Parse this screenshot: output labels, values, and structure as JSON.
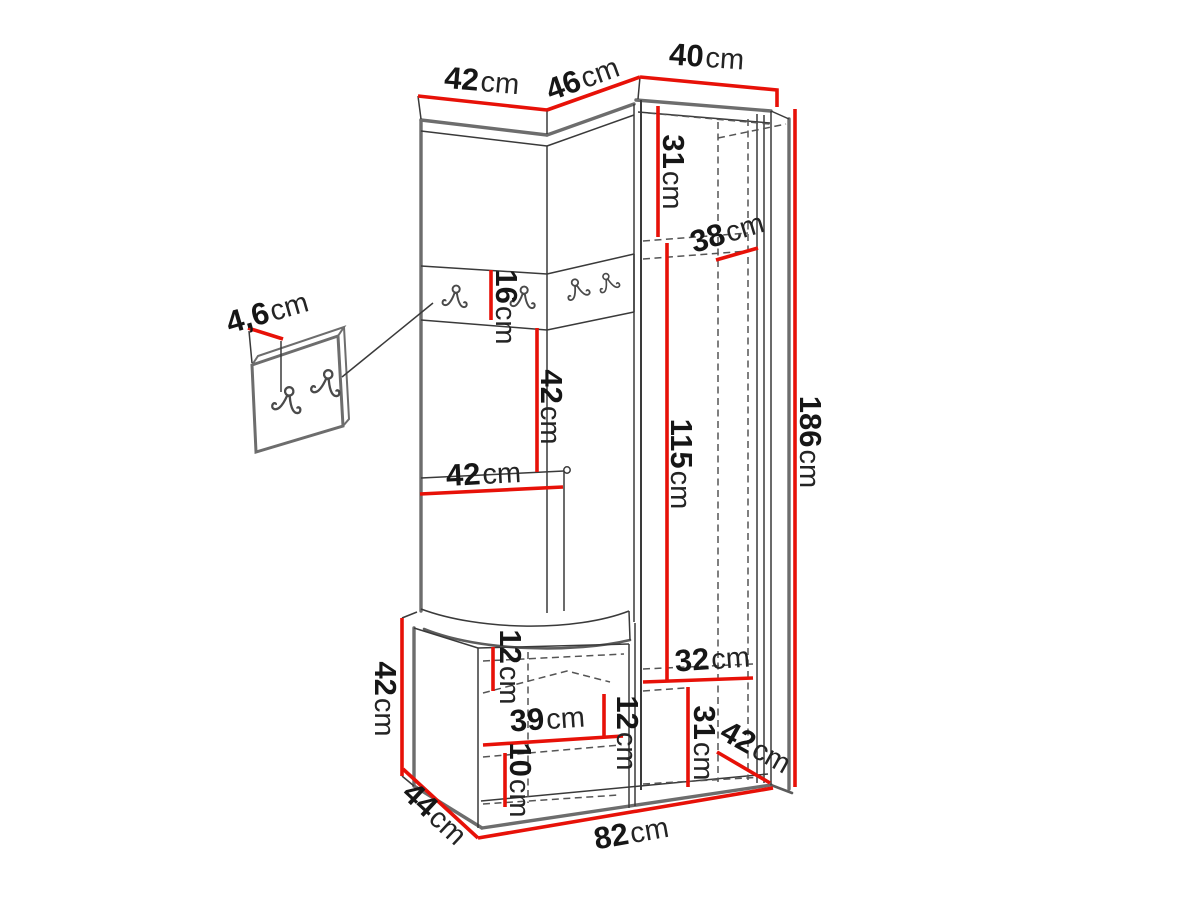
{
  "colors": {
    "dimension_line": "#e71108",
    "outline": "#6d6d6d",
    "detail_line": "#3a3a3a",
    "label_text": "#161616",
    "background": "#ffffff"
  },
  "icons": {
    "hook": "double-coat-hook-icon"
  },
  "dimensions": {
    "top_left_width": {
      "value": "42",
      "unit": "cm"
    },
    "top_middle_width": {
      "value": "46",
      "unit": "cm"
    },
    "top_right_width": {
      "value": "40",
      "unit": "cm"
    },
    "upper_inner_height": {
      "value": "31",
      "unit": "cm"
    },
    "shelf_depth": {
      "value": "38",
      "unit": "cm"
    },
    "hanging_space_height": {
      "value": "115",
      "unit": "cm"
    },
    "total_height": {
      "value": "186",
      "unit": "cm"
    },
    "hook_rail_height": {
      "value": "16",
      "unit": "cm"
    },
    "open_section_height": {
      "value": "42",
      "unit": "cm"
    },
    "open_section_width": {
      "value": "42",
      "unit": "cm"
    },
    "wall_panel_thickness": {
      "value": "4,6",
      "unit": "cm"
    },
    "bench_height": {
      "value": "42",
      "unit": "cm"
    },
    "bench_top_inner": {
      "value": "12",
      "unit": "cm"
    },
    "bench_inner_width": {
      "value": "39",
      "unit": "cm"
    },
    "bench_mid_inner": {
      "value": "12",
      "unit": "cm"
    },
    "bench_bottom_inner": {
      "value": "10",
      "unit": "cm"
    },
    "bench_depth": {
      "value": "44",
      "unit": "cm"
    },
    "base_width": {
      "value": "82",
      "unit": "cm"
    },
    "lower_inner_width": {
      "value": "32",
      "unit": "cm"
    },
    "lower_inner_height": {
      "value": "31",
      "unit": "cm"
    },
    "side_bottom_depth": {
      "value": "42",
      "unit": "cm"
    }
  }
}
